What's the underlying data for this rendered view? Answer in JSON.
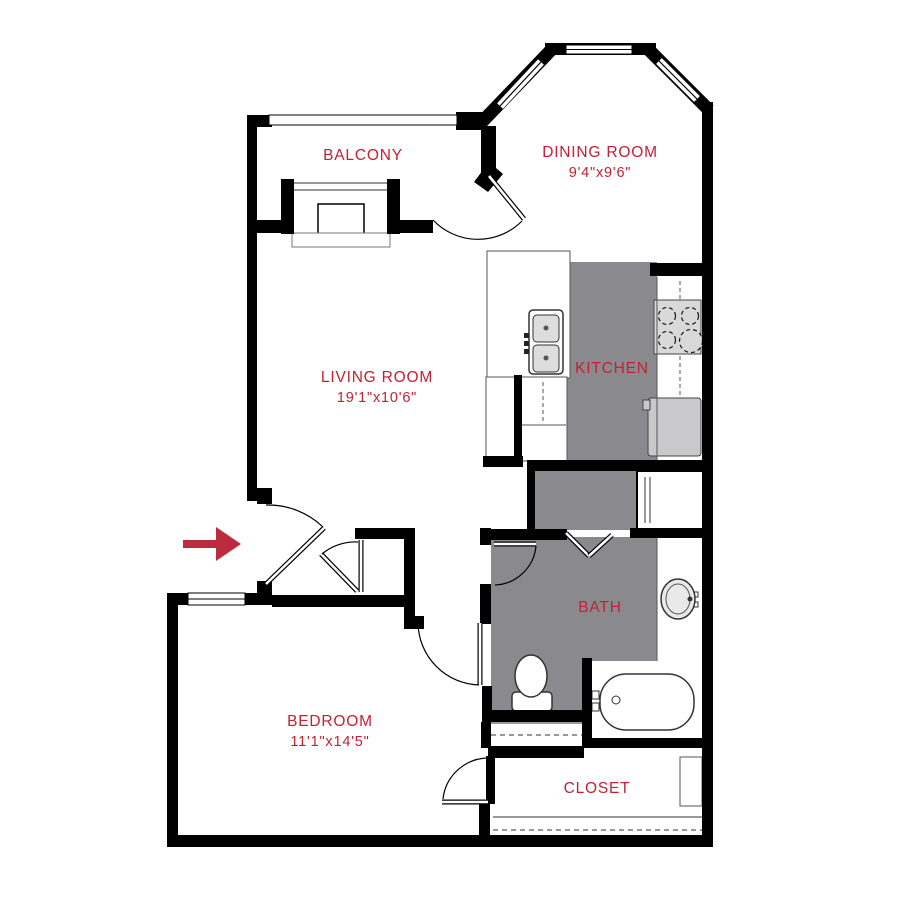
{
  "plan_title": "apartment-floor-plan",
  "colors": {
    "wall": "#000000",
    "floor_gray": "#8a8a8e",
    "label_red": "#c32133",
    "arrow_red": "#bc2b3e",
    "fixture_stroke": "#333333",
    "thin_stroke": "#555555",
    "appliance_fill": "#d9d9d9",
    "fridge_fill": "#c9c9cb",
    "basin_fill": "#dddddd",
    "background": "#ffffff"
  },
  "rooms": [
    {
      "id": "balcony",
      "label": "BALCONY",
      "dims": "",
      "x": 363,
      "y": 160
    },
    {
      "id": "dining",
      "label": "DINING ROOM",
      "dims": "9'4\"x9'6\"",
      "x": 600,
      "y": 157,
      "dims_y": 177
    },
    {
      "id": "living",
      "label": "LIVING ROOM",
      "dims": "19'1\"x10'6\"",
      "x": 377,
      "y": 382,
      "dims_y": 402
    },
    {
      "id": "kitchen",
      "label": "KITCHEN",
      "dims": "",
      "x": 612,
      "y": 373
    },
    {
      "id": "bath",
      "label": "BATH",
      "dims": "",
      "x": 600,
      "y": 612
    },
    {
      "id": "bedroom",
      "label": "BEDROOM",
      "dims": "11'1\"x14'5\"",
      "x": 330,
      "y": 726,
      "dims_y": 746
    },
    {
      "id": "closet",
      "label": "CLOSET",
      "dims": "",
      "x": 597,
      "y": 793
    }
  ],
  "arrow": {
    "shaft": {
      "x": 183,
      "y": 540,
      "w": 33,
      "h": 8
    },
    "head_points": "216,527 241,544 216,561"
  },
  "geometry": {
    "floors": [
      {
        "x": 566,
        "y": 262,
        "w": 91,
        "h": 199
      },
      {
        "x": 533,
        "y": 470,
        "w": 104,
        "h": 60
      },
      {
        "x": 491,
        "y": 537,
        "w": 166,
        "h": 124
      },
      {
        "x": 491,
        "y": 661,
        "w": 92,
        "h": 50
      }
    ],
    "rects": [
      {
        "x": 487,
        "y": 251,
        "w": 83,
        "h": 127,
        "fill": "#ffffff",
        "stroke": "#555555",
        "sw": 1
      },
      {
        "x": 486,
        "y": 377,
        "w": 29,
        "h": 81,
        "fill": "#ffffff",
        "stroke": "#555555",
        "sw": 1
      },
      {
        "x": 521,
        "y": 377,
        "w": 46,
        "h": 84,
        "fill": "#ffffff",
        "stroke": "#555555",
        "sw": 1
      },
      {
        "x": 529,
        "y": 310,
        "w": 34,
        "h": 64,
        "fill": "#ffffff",
        "stroke": "#333333",
        "sw": 1.5,
        "rx": 4
      },
      {
        "x": 533,
        "y": 315,
        "w": 26,
        "h": 27,
        "fill": "#dddddd",
        "stroke": "#333333",
        "sw": 1,
        "rx": 4
      },
      {
        "x": 533,
        "y": 345,
        "w": 26,
        "h": 27,
        "fill": "#dddddd",
        "stroke": "#333333",
        "sw": 1,
        "rx": 4
      },
      {
        "x": 524,
        "y": 333,
        "w": 5,
        "h": 5,
        "fill": "#222222",
        "stroke": "none",
        "sw": 0
      },
      {
        "x": 524,
        "y": 341,
        "w": 5,
        "h": 5,
        "fill": "#222222",
        "stroke": "none",
        "sw": 0
      },
      {
        "x": 524,
        "y": 349,
        "w": 5,
        "h": 5,
        "fill": "#222222",
        "stroke": "none",
        "sw": 0
      },
      {
        "x": 654,
        "y": 300,
        "w": 47,
        "h": 54,
        "fill": "#d9d9d9",
        "stroke": "#444444",
        "sw": 1
      },
      {
        "x": 648,
        "y": 398,
        "w": 53,
        "h": 58,
        "fill": "#c9c9cb",
        "stroke": "#444444",
        "sw": 1,
        "rx": 3
      },
      {
        "x": 643,
        "y": 400,
        "w": 7,
        "h": 10,
        "fill": "#c9c9cb",
        "stroke": "#444444",
        "sw": 1
      },
      {
        "x": 637,
        "y": 471,
        "w": 66,
        "h": 58,
        "fill": "#ffffff",
        "stroke": "#000000",
        "sw": 2
      },
      {
        "x": 592,
        "y": 661,
        "w": 110,
        "h": 77,
        "fill": "#ffffff",
        "stroke": "none",
        "sw": 0
      },
      {
        "x": 600,
        "y": 674,
        "w": 94,
        "h": 56,
        "fill": "#ffffff",
        "stroke": "#333333",
        "sw": 1.5,
        "rx": 26
      },
      {
        "x": 592,
        "y": 691,
        "w": 7,
        "h": 8,
        "fill": "#ffffff",
        "stroke": "#333333",
        "sw": 1
      },
      {
        "x": 592,
        "y": 703,
        "w": 7,
        "h": 8,
        "fill": "#ffffff",
        "stroke": "#333333",
        "sw": 1
      },
      {
        "x": 692,
        "y": 592,
        "w": 6,
        "h": 5,
        "fill": "#ffffff",
        "stroke": "#333333",
        "sw": 1
      },
      {
        "x": 692,
        "y": 602,
        "w": 6,
        "h": 5,
        "fill": "#ffffff",
        "stroke": "#333333",
        "sw": 1
      },
      {
        "x": 680,
        "y": 757,
        "w": 22,
        "h": 49,
        "fill": "#ffffff",
        "stroke": "#555555",
        "sw": 1
      },
      {
        "x": 318,
        "y": 204,
        "w": 46,
        "h": 30,
        "fill": "#ffffff",
        "stroke": "#000000",
        "sw": 1.5
      },
      {
        "x": 292,
        "y": 233,
        "w": 98,
        "h": 14,
        "fill": "#ffffff",
        "stroke": "#777777",
        "sw": 1
      },
      {
        "x": 512,
        "y": 692,
        "w": 40,
        "h": 19,
        "fill": "#ffffff",
        "stroke": "#333333",
        "sw": 1.5,
        "rx": 4
      }
    ],
    "ellipses": [
      {
        "cx": 531,
        "cy": 676,
        "rx": 16,
        "ry": 21,
        "fill": "#ffffff",
        "stroke": "#333333",
        "sw": 1.5
      },
      {
        "cx": 678,
        "cy": 599,
        "rx": 17,
        "ry": 20,
        "fill": "#e9e9e9",
        "stroke": "#333333",
        "sw": 1.5
      },
      {
        "cx": 678,
        "cy": 599,
        "rx": 12,
        "ry": 15,
        "fill": "none",
        "stroke": "#555555",
        "sw": 1
      },
      {
        "cx": 690,
        "cy": 599,
        "rx": 2.5,
        "ry": 2.5,
        "fill": "#333333",
        "stroke": "none",
        "sw": 0
      },
      {
        "cx": 546,
        "cy": 328,
        "rx": 2.5,
        "ry": 2.5,
        "fill": "#555555",
        "stroke": "none",
        "sw": 0
      },
      {
        "cx": 546,
        "cy": 358,
        "rx": 2.5,
        "ry": 2.5,
        "fill": "#555555",
        "stroke": "none",
        "sw": 0
      },
      {
        "cx": 667,
        "cy": 316,
        "rx": 8.5,
        "ry": 8.5,
        "fill": "#d9d9d9",
        "stroke": "#222222",
        "sw": 1.3,
        "dash": "4,3"
      },
      {
        "cx": 690,
        "cy": 316,
        "rx": 8.5,
        "ry": 8.5,
        "fill": "#d9d9d9",
        "stroke": "#222222",
        "sw": 1.3,
        "dash": "4,3"
      },
      {
        "cx": 667,
        "cy": 340,
        "rx": 8.5,
        "ry": 8.5,
        "fill": "#d9d9d9",
        "stroke": "#222222",
        "sw": 1.3,
        "dash": "4,3"
      },
      {
        "cx": 691,
        "cy": 341,
        "rx": 11.5,
        "ry": 11.5,
        "fill": "#d9d9d9",
        "stroke": "#222222",
        "sw": 1.3,
        "dash": "4,3"
      },
      {
        "cx": 616,
        "cy": 700,
        "rx": 4,
        "ry": 4,
        "fill": "none",
        "stroke": "#333333",
        "sw": 1
      }
    ],
    "strokes": [
      {
        "x1": 480,
        "y1": 124,
        "x2": 553,
        "y2": 48,
        "w": 13,
        "color": "#000000"
      },
      {
        "x1": 500,
        "y1": 106,
        "x2": 541,
        "y2": 62,
        "w": 8,
        "color": "#ffffff"
      },
      {
        "x1": 500,
        "y1": 106,
        "x2": 541,
        "y2": 62,
        "w": 1.2,
        "color": "#000000"
      },
      {
        "x1": 649,
        "y1": 50,
        "x2": 709,
        "y2": 110,
        "w": 13,
        "color": "#000000"
      },
      {
        "x1": 659,
        "y1": 61,
        "x2": 697,
        "y2": 99,
        "w": 8,
        "color": "#ffffff"
      },
      {
        "x1": 659,
        "y1": 61,
        "x2": 697,
        "y2": 99,
        "w": 1.2,
        "color": "#000000"
      },
      {
        "x1": 520,
        "y1": 425,
        "x2": 566,
        "y2": 425,
        "w": 1,
        "color": "#555555"
      },
      {
        "x1": 543,
        "y1": 382,
        "x2": 543,
        "y2": 424,
        "w": 1,
        "color": "#555555",
        "dash": "4,3"
      },
      {
        "x1": 680,
        "y1": 281,
        "x2": 680,
        "y2": 299,
        "w": 1,
        "color": "#555555",
        "dash": "4,3"
      },
      {
        "x1": 680,
        "y1": 356,
        "x2": 680,
        "y2": 397,
        "w": 1,
        "color": "#555555",
        "dash": "4,3"
      },
      {
        "x1": 657,
        "y1": 277,
        "x2": 657,
        "y2": 460,
        "w": 1,
        "color": "#555555"
      },
      {
        "x1": 657,
        "y1": 537,
        "x2": 657,
        "y2": 661,
        "w": 1,
        "color": "#555555"
      },
      {
        "x1": 491,
        "y1": 723,
        "x2": 582,
        "y2": 723,
        "w": 1,
        "color": "#333333"
      },
      {
        "x1": 491,
        "y1": 735,
        "x2": 582,
        "y2": 735,
        "w": 1,
        "color": "#333333",
        "dash": "5,4"
      },
      {
        "x1": 493,
        "y1": 817,
        "x2": 702,
        "y2": 817,
        "w": 1,
        "color": "#333333"
      },
      {
        "x1": 493,
        "y1": 830,
        "x2": 702,
        "y2": 830,
        "w": 1,
        "color": "#333333",
        "dash": "5,4"
      },
      {
        "x1": 294,
        "y1": 183,
        "x2": 387,
        "y2": 183,
        "w": 1,
        "color": "#333333"
      },
      {
        "x1": 294,
        "y1": 190,
        "x2": 387,
        "y2": 190,
        "w": 1,
        "color": "#333333"
      },
      {
        "x1": 645,
        "y1": 477,
        "x2": 645,
        "y2": 523,
        "w": 1,
        "color": "#333333"
      },
      {
        "x1": 650,
        "y1": 477,
        "x2": 650,
        "y2": 523,
        "w": 1,
        "color": "#333333"
      }
    ],
    "walls": [
      {
        "x": 247,
        "y": 115,
        "w": 10,
        "h": 386
      },
      {
        "x": 247,
        "y": 115,
        "w": 25,
        "h": 12
      },
      {
        "x": 456,
        "y": 112,
        "w": 29,
        "h": 18
      },
      {
        "x": 545,
        "y": 43,
        "w": 111,
        "h": 12
      },
      {
        "x": 702,
        "y": 102,
        "w": 11,
        "h": 745
      },
      {
        "x": 167,
        "y": 835,
        "w": 546,
        "h": 12
      },
      {
        "x": 167,
        "y": 593,
        "w": 11,
        "h": 254
      },
      {
        "x": 247,
        "y": 220,
        "w": 47,
        "h": 13
      },
      {
        "x": 388,
        "y": 220,
        "w": 45,
        "h": 13
      },
      {
        "x": 281,
        "y": 179,
        "w": 13,
        "h": 55
      },
      {
        "x": 387,
        "y": 179,
        "w": 13,
        "h": 55
      },
      {
        "x": 481,
        "y": 126,
        "w": 15,
        "h": 49
      },
      {
        "x": 650,
        "y": 263,
        "w": 52,
        "h": 13
      },
      {
        "x": 514,
        "y": 375,
        "w": 8,
        "h": 86
      },
      {
        "x": 483,
        "y": 456,
        "w": 40,
        "h": 11
      },
      {
        "x": 527,
        "y": 460,
        "w": 176,
        "h": 11
      },
      {
        "x": 527,
        "y": 460,
        "w": 8,
        "h": 72
      },
      {
        "x": 487,
        "y": 529,
        "w": 80,
        "h": 11
      },
      {
        "x": 630,
        "y": 528,
        "w": 74,
        "h": 10
      },
      {
        "x": 480,
        "y": 528,
        "w": 11,
        "h": 17
      },
      {
        "x": 480,
        "y": 584,
        "w": 11,
        "h": 40
      },
      {
        "x": 482,
        "y": 686,
        "w": 10,
        "h": 36
      },
      {
        "x": 488,
        "y": 710,
        "w": 96,
        "h": 12
      },
      {
        "x": 481,
        "y": 722,
        "w": 10,
        "h": 26
      },
      {
        "x": 582,
        "y": 658,
        "w": 10,
        "h": 90
      },
      {
        "x": 488,
        "y": 746,
        "w": 96,
        "h": 12
      },
      {
        "x": 486,
        "y": 756,
        "w": 9,
        "h": 48
      },
      {
        "x": 479,
        "y": 803,
        "w": 11,
        "h": 34
      },
      {
        "x": 590,
        "y": 738,
        "w": 113,
        "h": 10
      },
      {
        "x": 355,
        "y": 528,
        "w": 54,
        "h": 11
      },
      {
        "x": 404,
        "y": 528,
        "w": 11,
        "h": 90
      },
      {
        "x": 404,
        "y": 616,
        "w": 20,
        "h": 13
      },
      {
        "x": 167,
        "y": 593,
        "w": 21,
        "h": 12
      },
      {
        "x": 245,
        "y": 593,
        "w": 27,
        "h": 12
      },
      {
        "x": 272,
        "y": 595,
        "w": 133,
        "h": 12
      },
      {
        "x": 257,
        "y": 581,
        "w": 15,
        "h": 17
      },
      {
        "x": 257,
        "y": 488,
        "w": 15,
        "h": 16
      }
    ],
    "polys": [
      {
        "points": "474,182 489,162 503,174 488,192",
        "fill": "#000000"
      }
    ],
    "windows": [
      {
        "x": 188,
        "y": 593,
        "w": 57,
        "h": 12,
        "center": "h"
      },
      {
        "x": 269,
        "y": 115,
        "w": 188,
        "h": 10,
        "center": "none"
      },
      {
        "x": 566,
        "y": 45,
        "w": 66,
        "h": 9,
        "center": "h"
      }
    ],
    "leaves": [
      {
        "x1": 266,
        "y1": 584,
        "x2": 324,
        "y2": 528
      },
      {
        "x1": 357,
        "y1": 591,
        "x2": 321,
        "y2": 554
      },
      {
        "x1": 361,
        "y1": 540,
        "x2": 361,
        "y2": 592
      },
      {
        "x1": 489,
        "y1": 176,
        "x2": 524,
        "y2": 219
      },
      {
        "x1": 494,
        "y1": 544,
        "x2": 536,
        "y2": 544
      },
      {
        "x1": 480,
        "y1": 623,
        "x2": 480,
        "y2": 685
      },
      {
        "x1": 442,
        "y1": 802,
        "x2": 488,
        "y2": 802
      },
      {
        "x1": 566,
        "y1": 533,
        "x2": 589,
        "y2": 556
      },
      {
        "x1": 589,
        "y1": 556,
        "x2": 612,
        "y2": 535
      }
    ],
    "arcs": [
      {
        "d": "M 266,505 A 79 79 0 0 1 323,527"
      },
      {
        "d": "M 322,554 A 52 52 0 0 1 358,542"
      },
      {
        "d": "M 522,221 A 62 62 0 0 1 433,220"
      },
      {
        "d": "M 536,546 A 43 43 0 0 1 495,585"
      },
      {
        "d": "M 418,623 A 63 63 0 0 0 479,685"
      },
      {
        "d": "M 443,799 A 46 46 0 0 1 490,758"
      }
    ]
  }
}
